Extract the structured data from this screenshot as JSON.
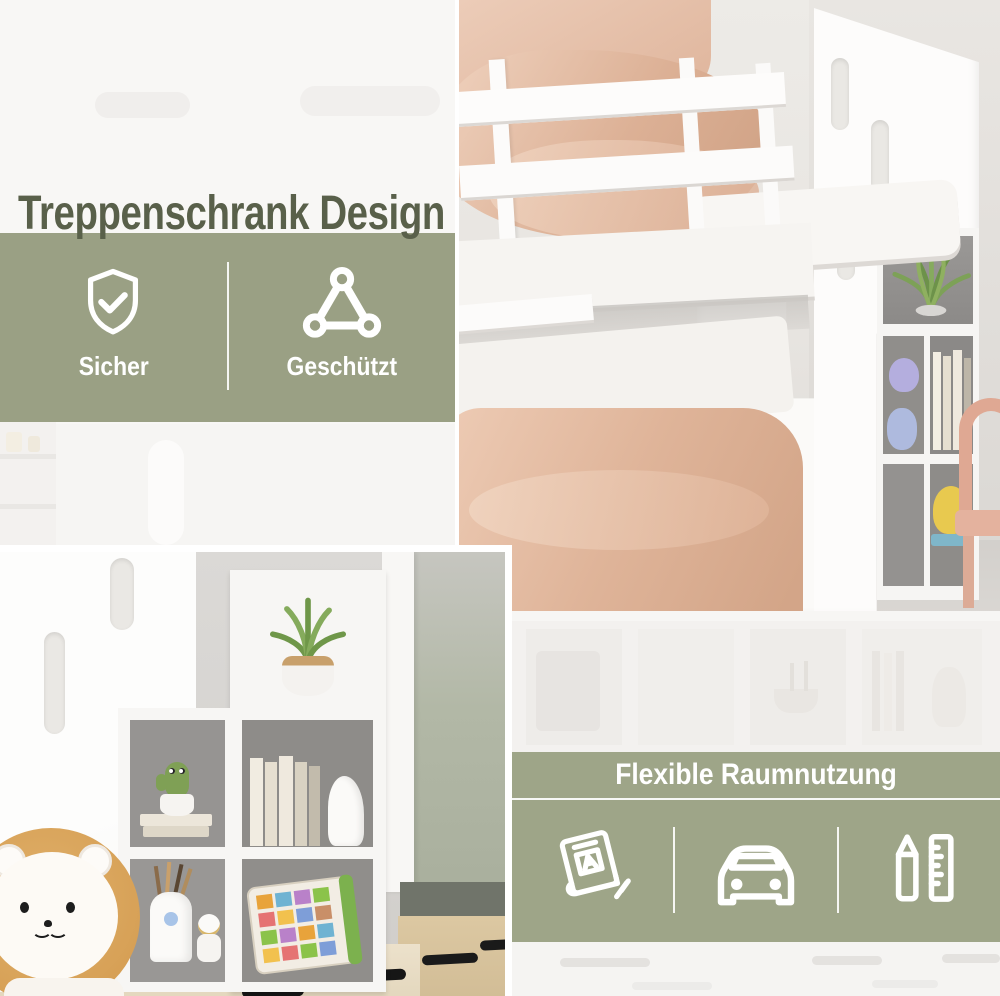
{
  "colors": {
    "accent_green": "#9aa084",
    "overlay_green": "rgba(152,159,129,0.94)",
    "heading_text": "#59604a",
    "band_text": "#ffffff"
  },
  "heading": {
    "title": "Treppenschrank Design"
  },
  "safety_band": {
    "items": [
      {
        "icon": "shield-check-icon",
        "label": "Sicher"
      },
      {
        "icon": "triangle-link-icon",
        "label": "Geschützt"
      }
    ]
  },
  "flexibility_band": {
    "title": "Flexible Raumnutzung",
    "icons": [
      {
        "icon": "book-icon"
      },
      {
        "icon": "car-icon"
      },
      {
        "icon": "pencil-ruler-icon"
      }
    ]
  },
  "photos": {
    "top_right": "bunk-bed-with-staircase-storage",
    "bottom_left": "staircase-shelf-with-toys-and-lion-plush"
  }
}
